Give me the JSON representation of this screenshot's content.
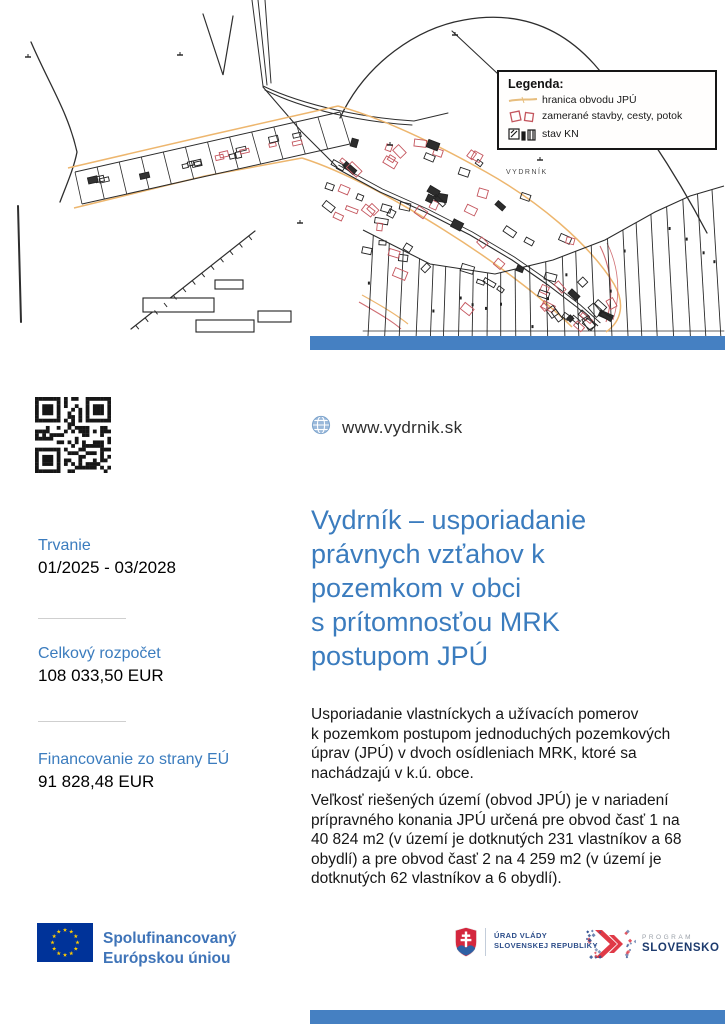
{
  "map": {
    "place_label": "VYDRNÍK",
    "legend": {
      "title": "Legenda:",
      "items": [
        {
          "icon": "boundary-line-icon",
          "label": "hranica obvodu JPÚ"
        },
        {
          "icon": "surveyed-objects-icon",
          "label": "zamerané stavby, cesty, potok"
        },
        {
          "icon": "cadastre-state-icon",
          "label": "stav KN"
        }
      ]
    }
  },
  "website": {
    "icon": "globe-icon",
    "url": "www.vydrnik.sk"
  },
  "info": {
    "items": [
      {
        "label": "Trvanie",
        "value": "01/2025 - 03/2028"
      },
      {
        "label": "Celkový rozpočet",
        "value": "108 033,50 EUR"
      },
      {
        "label": "Financovanie zo strany EÚ",
        "value": "91 828,48 EUR"
      }
    ]
  },
  "main": {
    "title_lines": [
      "Vydrník – usporiadanie",
      "právnych vzťahov k",
      "pozemkom v obci",
      "s prítomnosťou MRK",
      "postupom JPÚ"
    ],
    "paragraphs": [
      {
        "lines": [
          "Usporiadanie vlastníckych a užívacích pomerov",
          "k pozemkom postupom jednoduchých pozemkových",
          "úprav (JPÚ) v dvoch osídleniach MRK, ktoré sa",
          "nachádzajú v k.ú. obce."
        ]
      },
      {
        "lines": [
          "Veľkosť riešených území (obvod JPÚ) je v nariadení",
          "prípravného konania JPÚ určená pre obvod časť 1 na",
          "40 824 m2 (v území je dotknutých 231 vlastníkov a 68",
          "obydlí) a pre obvod časť 2 na 4 259 m2 (v území je",
          "dotknutých 62 vlastníkov a 6 obydlí)."
        ]
      }
    ]
  },
  "footer": {
    "eu": {
      "line1": "Spolufinancovaný",
      "line2": "Európskou úniou"
    },
    "gov": {
      "line1": "ÚRAD VLÁDY",
      "line2": "SLOVENSKEJ REPUBLIKY"
    },
    "program": {
      "line1": "PROGRAM",
      "line2": "SLOVENSKO"
    }
  },
  "colors": {
    "accent_blue": "#3b7cbe",
    "bar_blue": "#4580c2",
    "text_dark": "#1c1c1c",
    "eu_flag_blue": "#003399",
    "eu_star_yellow": "#ffcc00",
    "eu_text_blue": "#3f74b8",
    "gov_text_blue": "#2d4e8a",
    "program_red": "#e03a47",
    "program_blue": "#2e4f90",
    "program_navy": "#1d3b6e",
    "program_gray": "#9aa0a8",
    "map_boundary_orange": "#edb66e",
    "map_feature_red": "#c4565e"
  }
}
